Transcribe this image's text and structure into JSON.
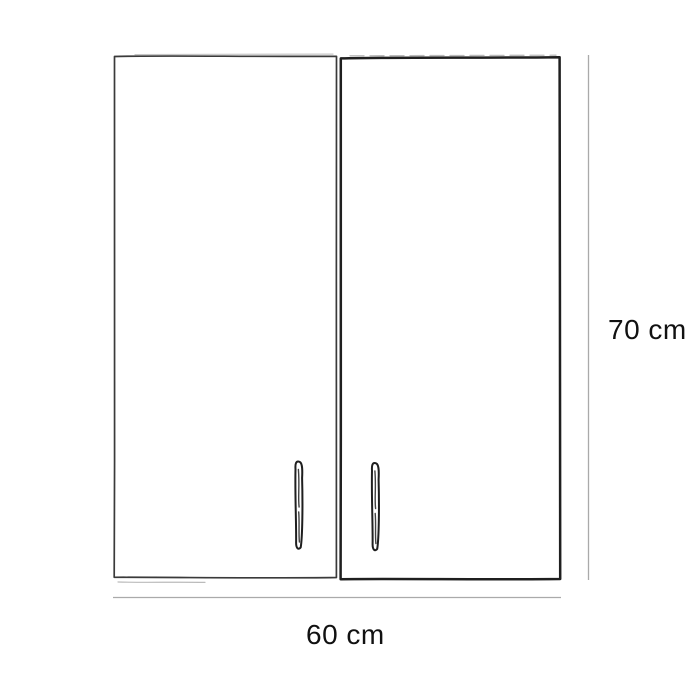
{
  "diagram": {
    "labels": {
      "height": "70 cm",
      "width": "60 cm"
    },
    "colors": {
      "ink": "#1f1f1f",
      "ink_light": "#3a3a3a",
      "dimension_line": "#aaaaaa",
      "text": "#111111",
      "background": "#ffffff"
    }
  }
}
